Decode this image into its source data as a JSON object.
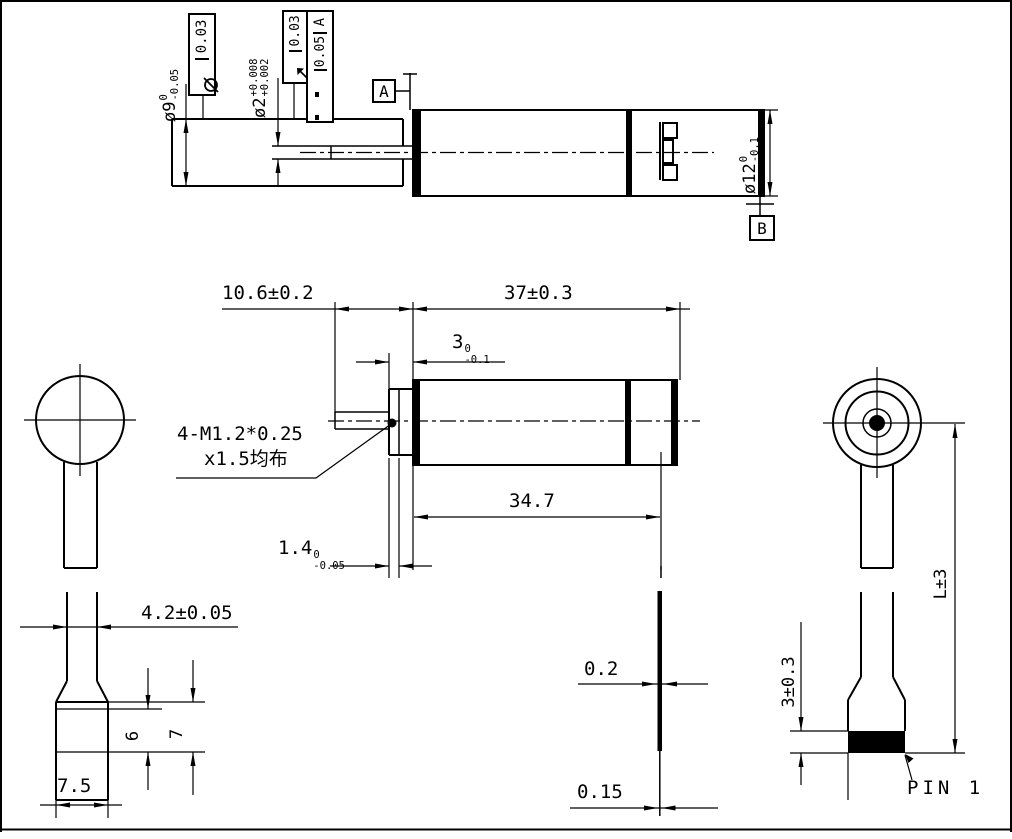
{
  "top_view": {
    "dim_phi9": {
      "main": "ø9",
      "sup": "0",
      "sub": "-0.05"
    },
    "fcf_phi9": {
      "symbol": "circle-slash",
      "value": "0.03"
    },
    "dim_phi2": {
      "main": "ø2",
      "sup": "+0.008",
      "sub": "+0.002"
    },
    "fcf_phi2_runout": {
      "symbol": "runout-arrow",
      "value": "0.03"
    },
    "fcf_phi2_datum": {
      "cells": [
        "",
        "",
        "0.05",
        "A"
      ],
      "value": "0.05",
      "datum": "A"
    },
    "datum_a_label": "A",
    "datum_b_label": "B",
    "dim_phi12": {
      "main": "ø12",
      "sup": "0",
      "sub": "-0.1"
    }
  },
  "front_view": {
    "dim_shaft_len": "10.6±0.2",
    "dim_body_len": "37±0.3",
    "dim_boss_len": {
      "main": "3",
      "sup": "0",
      "sub": "-0.1"
    },
    "dim_flange": {
      "main": "1.4",
      "sup": "0",
      "sub": "-0.05"
    },
    "dim_can_len": "34.7",
    "thread_note_line1": "4-M1.2*0.25",
    "thread_note_line2": "x1.5均布"
  },
  "left_view": {
    "dim_cable_width": "4.2±0.05",
    "dim_contact_len": "6",
    "dim_connector_len": "7",
    "dim_connector_width": "7.5"
  },
  "cable_edge_view": {
    "dim_thickness_connector": "0.2",
    "dim_thickness_fpc": "0.15"
  },
  "right_view": {
    "dim_cable_length": "L±3",
    "dim_connector_height": "3±0.3",
    "pin1_label": "PIN 1"
  }
}
